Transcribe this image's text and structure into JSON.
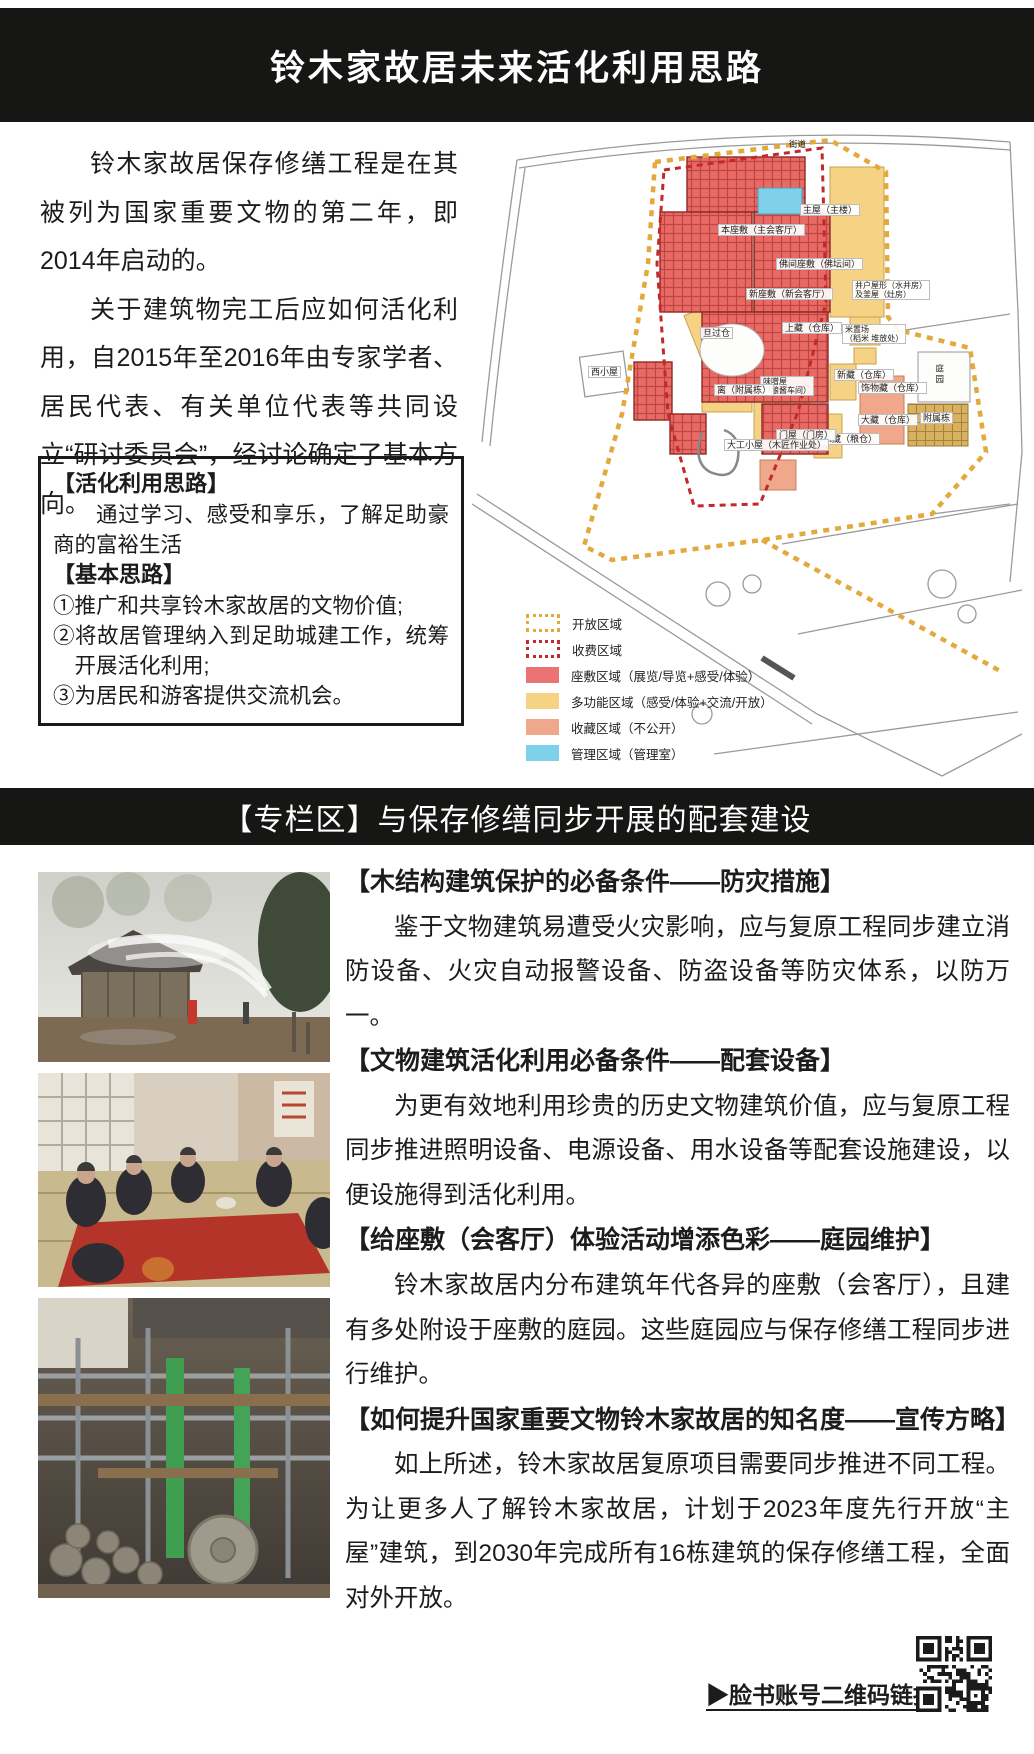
{
  "header": {
    "title": "铃木家故居未来活化利用思路"
  },
  "intro": {
    "p1": "铃木家故居保存修缮工程是在其被列为国家重要文物的第二年，即2014年启动的。",
    "p2": "关于建筑物完工后应如何活化利用，自2015年至2016年由专家学者、居民代表、有关单位代表等共同设立“研讨委员会”，经讨论确定了基本方向。"
  },
  "idea_box": {
    "title1": "【活化利用思路】",
    "body1": "通过学习、感受和享乐，了解足助豪商的富裕生活",
    "title2": "【基本思路】",
    "items": [
      "①推广和共享铃木家故居的文物价值;",
      "②将故居管理纳入到足助城建工作，统筹开展活化利用;",
      "③为居民和游客提供交流机会。"
    ]
  },
  "map": {
    "street_label": "街道",
    "labels": [
      {
        "text": "主屋（主楼）"
      },
      {
        "text": "本座敷（主会客厅）"
      },
      {
        "text": "佛间座敷（佛坛间）"
      },
      {
        "text": "新座敷（新会客厅）"
      },
      {
        "text": "上藏（仓库）"
      },
      {
        "text": "旦过仓"
      },
      {
        "text": "井户屋形（水井房）\n及釜屋（灶房）"
      },
      {
        "text": "米置场\n（稻米 堆放处）"
      },
      {
        "text": "新藏（仓库）"
      },
      {
        "text": "饰物藏（仓库）"
      },
      {
        "text": "大藏（仓库）"
      },
      {
        "text": "附属栋"
      },
      {
        "text": "米藏（粮仓）"
      },
      {
        "text": "门屋（门房）"
      },
      {
        "text": "味噌屋\n（酿酱车间）"
      },
      {
        "text": "离（附属栋）"
      },
      {
        "text": "西小屋"
      },
      {
        "text": "大工小屋（木匠作业处）"
      },
      {
        "text": "庭园"
      }
    ],
    "legend": [
      {
        "label": "开放区域",
        "color": "#e2a93c"
      },
      {
        "label": "收费区域",
        "color": "#c3292b"
      },
      {
        "label": "座敷区域（展览/导览+感受/体验）",
        "color": "#ec7373"
      },
      {
        "label": "多功能区域（感受/体验+交流/开放）",
        "color": "#f5d284"
      },
      {
        "label": "收藏区域（不公开）",
        "color": "#f0a88c"
      },
      {
        "label": "管理区域（管理室）",
        "color": "#7fd0e9"
      }
    ]
  },
  "section2": {
    "title": "【专栏区】与保存修缮同步开展的配套建设"
  },
  "articles": [
    {
      "heading": "【木结构建筑保护的必备条件——防灾措施】",
      "body": "鉴于文物建筑易遭受火灾影响，应与复原工程同步建立消防设备、火灾自动报警设备、防盗设备等防灾体系，以防万一。"
    },
    {
      "heading": "【文物建筑活化利用必备条件——配套设备】",
      "body": "为更有效地利用珍贵的历史文物建筑价值，应与复原工程同步推进照明设备、电源设备、用水设备等配套设施建设，以便设施得到活化利用。"
    },
    {
      "heading": "【给座敷（会客厅）体验活动增添色彩——庭园维护】",
      "body": "铃木家故居内分布建筑年代各异的座敷（会客厅），且建有多处附设于座敷的庭园。这些庭园应与保存修缮工程同步进行维护。"
    },
    {
      "heading": "【如何提升国家重要文物铃木家故居的知名度——宣传方略】",
      "body": "如上所述，铃木家故居复原项目需要同步推进不同工程。为让更多人了解铃木家故居，计划于2023年度先行开放“主屋”建筑，到2030年完成所有16栋建筑的保存修缮工程，全面对外开放。"
    }
  ],
  "footer": {
    "qr_caption": "▶脸书账号二维码链接"
  }
}
